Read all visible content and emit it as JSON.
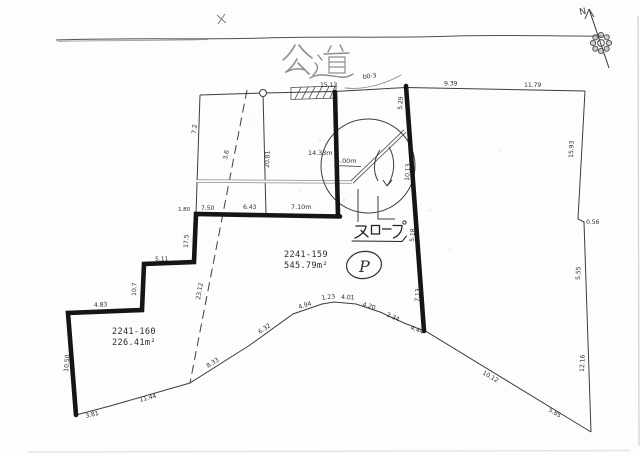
{
  "road": {
    "label": "公道"
  },
  "compass": {
    "north": "N"
  },
  "parcels": {
    "main": {
      "number": "2241-159",
      "area": "545.79m²"
    },
    "west": {
      "number": "2241-160",
      "area": "226.41m²"
    }
  },
  "features": {
    "slope_label": "スロープ",
    "parking": "P",
    "ramp_width": "4.00m",
    "ramp_length": "14.33m",
    "benchmark": "b0-3"
  },
  "dims": {
    "top_seg": "15.13",
    "top_right_a": "9.39",
    "top_right_b": "11.79",
    "right_upper": "15.93",
    "right_step": "0.56",
    "right_mid": "5.55",
    "right_lower": "12.16",
    "se_edge_a": "10.12",
    "se_edge_b": "5.85",
    "south_1": "3.81",
    "south_2": "11.44",
    "south_3": "8.33",
    "south_4": "6.32",
    "south_5": "4.94",
    "south_6": "1.23",
    "south_7": "4.01",
    "south_8": "4.20",
    "south_9": "2.34",
    "south_10": "4.44",
    "mid_row_a": "7.50",
    "mid_row_b": "6.43",
    "mid_row_c": "7.10m",
    "stair_top": "1.80",
    "stair_v1": "17.5",
    "stair_h1": "5.11",
    "stair_v2": "10.7",
    "stair_h2": "4.83",
    "west_edge": "10.50",
    "inner_vertical": "20.81",
    "nw_edge": "7.2",
    "dashed_upper": "3.6",
    "dashed_lower": "23.12",
    "road_line_1": "5.29",
    "road_line_2": "10.13",
    "road_line_3": "5.18",
    "road_line_4": "7.13"
  }
}
